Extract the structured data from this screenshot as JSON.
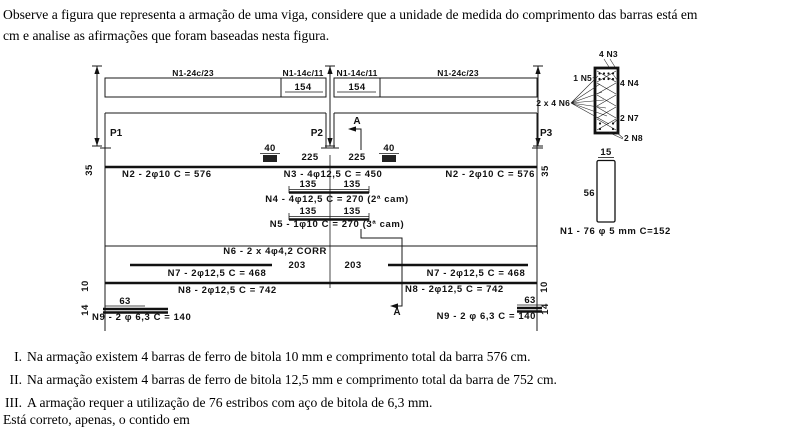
{
  "intro": {
    "line1": "Observe a figura que representa a armação de uma viga, considere que a unidade de medida do comprimento das barras está em",
    "line2": "cm e analise as afirmações que foram baseadas nesta figura."
  },
  "diagram": {
    "stirrup_zones": {
      "left_outer": "N1-24c/23",
      "left_inner": "N1-14c/11",
      "left_inner_len": "154",
      "right_inner": "N1-14c/11",
      "right_inner_len": "154",
      "right_outer": "N1-24c/23"
    },
    "columns": {
      "p1": "P1",
      "p2": "P2",
      "p3": "P3"
    },
    "section_mark": "A",
    "dims": {
      "d40": "40",
      "d225": "225",
      "d35": "35",
      "d135": "135",
      "d203": "203",
      "d10": "10",
      "d63": "63",
      "d14": "14",
      "d15": "15",
      "d56": "56"
    },
    "bars": {
      "n2": "N2 - 2φ10 C = 576",
      "n3": "N3 - 4φ12,5 C = 450",
      "n4": "N4 - 4φ12,5 C = 270 (2ª cam)",
      "n5": "N5 - 1φ10 C = 270 (3ª cam)",
      "n6": "N6 - 2 x 4φ4,2 CORR",
      "n7": "N7 - 2φ12,5 C = 468",
      "n8": "N8 - 2φ12,5 C = 742",
      "n9": "N9 - 2 φ 6,3 C = 140",
      "n1": "N1 - 76 φ 5 mm C=152"
    },
    "cross_section": {
      "top": "4 N3",
      "left_top": "1 N5",
      "right_top": "4 N4",
      "left_mid": "2 x 4 N6",
      "right_low": "2 N7",
      "bottom": "2 N8"
    }
  },
  "statements": [
    {
      "numeral": "I.",
      "text": "Na armação existem 4 barras de ferro de bitola 10 mm e comprimento total da barra 576 cm."
    },
    {
      "numeral": "II.",
      "text": "Na armação existem 4 barras de ferro de bitola 12,5 mm e comprimento total da barra de 752 cm."
    },
    {
      "numeral": "III.",
      "text": "A armação requer a utilização de 76 estribos com aço de bitola de 6,3 mm."
    }
  ],
  "closing": "Está correto, apenas, o contido em"
}
